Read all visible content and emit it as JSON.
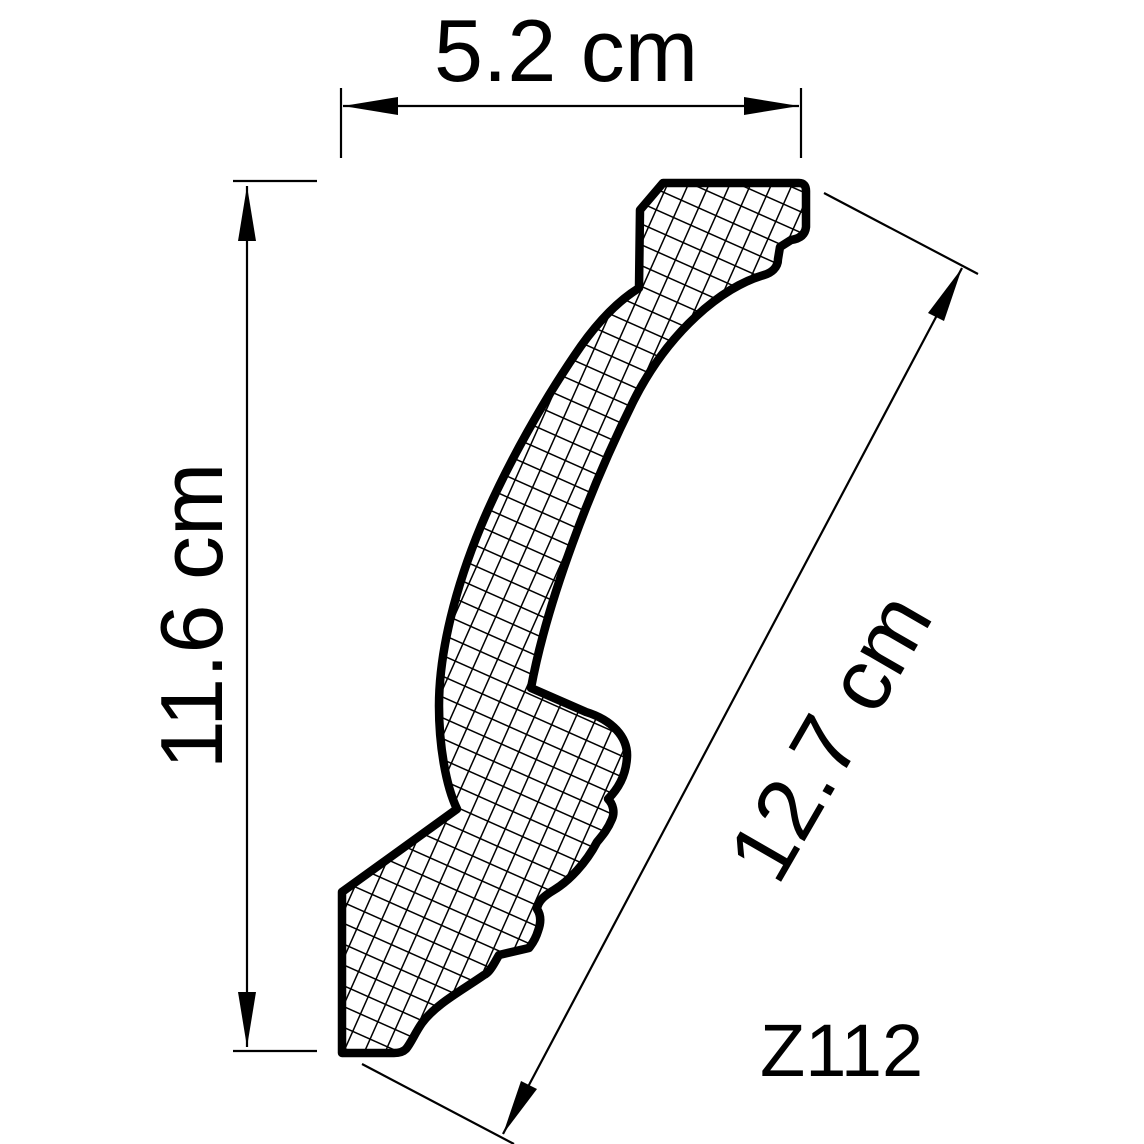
{
  "drawing": {
    "product_code": "Z112",
    "dimensions": {
      "width_label": "5.2 cm",
      "height_label": "11.6 cm",
      "face_label": "12.7 cm"
    },
    "colors": {
      "background": "#ffffff",
      "ink": "#000000"
    }
  }
}
